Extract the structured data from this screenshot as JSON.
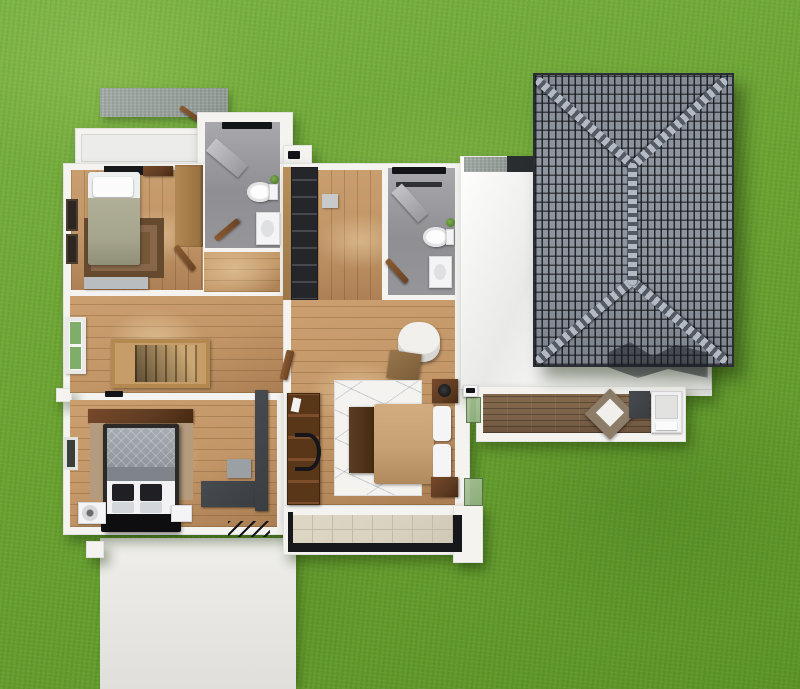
{
  "scene": {
    "title": "3D aerial rendering — second floor plan of a two-storey house on a lawn",
    "view": "top-down 3D dollhouse view",
    "visible_text": "none"
  },
  "palette": {
    "grass": "#6ca433",
    "grass_light": "#7cb545",
    "grass_dark": "#5c9427",
    "wall": "#f4f3f0",
    "wood_floor": "#c29667",
    "deck_wood": "#7b6248",
    "bath_floor": "#8f8f93",
    "bath_floor_light": "#a9a9ad",
    "roof_tile": "#8f96a0",
    "roof_white": "#f1f1ee",
    "rug_brown": "#775839",
    "duvet_sage": "#a5a48c",
    "bed_tan": "#c7a173",
    "dark_wood": "#5e3b22",
    "charcoal": "#3a3e42",
    "balcony_tile": "#d9d2c0",
    "balcony_tile_line": "#c2bba9",
    "concrete": "#a3aca6",
    "driveway": "#e9e8e4",
    "glass_green": "#8fae7e",
    "window_green": "#7fae6b",
    "rail_dark": "#17181c"
  },
  "regions": {
    "yard": {
      "label": "Lawn / yard"
    },
    "driveway": {
      "label": "Driveway slab"
    },
    "concrete_pad": {
      "label": "Concrete pad (carport roof)"
    },
    "ledge": {
      "label": "Lower-floor roof ledge"
    },
    "bedroom1": {
      "label": "Bedroom 1 (top left)"
    },
    "bathroom1": {
      "label": "Bathroom 1 with shower, toilet and sink"
    },
    "landing": {
      "label": "Landing outside bathroom 1"
    },
    "hall": {
      "label": "Stair hall"
    },
    "stairs": {
      "label": "Staircase to ground floor"
    },
    "master_bedroom": {
      "label": "Bedroom 3 (bottom left)"
    },
    "closet": {
      "label": "Built-in wardrobe column"
    },
    "corridor": {
      "label": "Central corridor"
    },
    "bathroom2": {
      "label": "Bathroom 2 with shower, toilet and sink"
    },
    "bedroom2": {
      "label": "Master bedroom (right)"
    },
    "balcony": {
      "label": "Tiled balcony with dark railing"
    },
    "deck": {
      "label": "Timber deck terrace"
    },
    "flat_roof": {
      "label": "White flat roof of right wing"
    },
    "tiled_roof": {
      "label": "Gray tiled hip roof"
    }
  },
  "furniture": {
    "bed1": {
      "label": "Single bed, sage duvet"
    },
    "rug1": {
      "label": "Brown area rug"
    },
    "wardrobe1": {
      "label": "Timber wardrobe"
    },
    "bench1": {
      "label": "Gray bench"
    },
    "toilet": {
      "label": "Toilet"
    },
    "sink": {
      "label": "Wash basin"
    },
    "shower": {
      "label": "Shower screen"
    },
    "stairs": {
      "label": "Timber staircase"
    },
    "hall_window": {
      "label": "Window with green glazing"
    },
    "master_bed": {
      "label": "Double bed, gray and white bedding"
    },
    "nightstand": {
      "label": "Nightstand"
    },
    "dresser": {
      "label": "Dark timber dresser"
    },
    "tv_console": {
      "label": "Charcoal TV console"
    },
    "swivel_chair": {
      "label": "White swivel chair"
    },
    "ottoman": {
      "label": "Brown ottoman"
    },
    "bed2": {
      "label": "Double bed, tan duvet"
    },
    "rug2": {
      "label": "White patterned rug"
    },
    "foot_bench": {
      "label": "Dark timber foot bench"
    },
    "desk_unit": {
      "label": "Dark timber desk / shelving with chair"
    },
    "lounge_chair": {
      "label": "Outdoor lounge chair"
    },
    "planter": {
      "label": "Charcoal planter"
    },
    "day_bed": {
      "label": "White outdoor day bed"
    },
    "grate": {
      "label": "Drainage grate marks"
    }
  }
}
